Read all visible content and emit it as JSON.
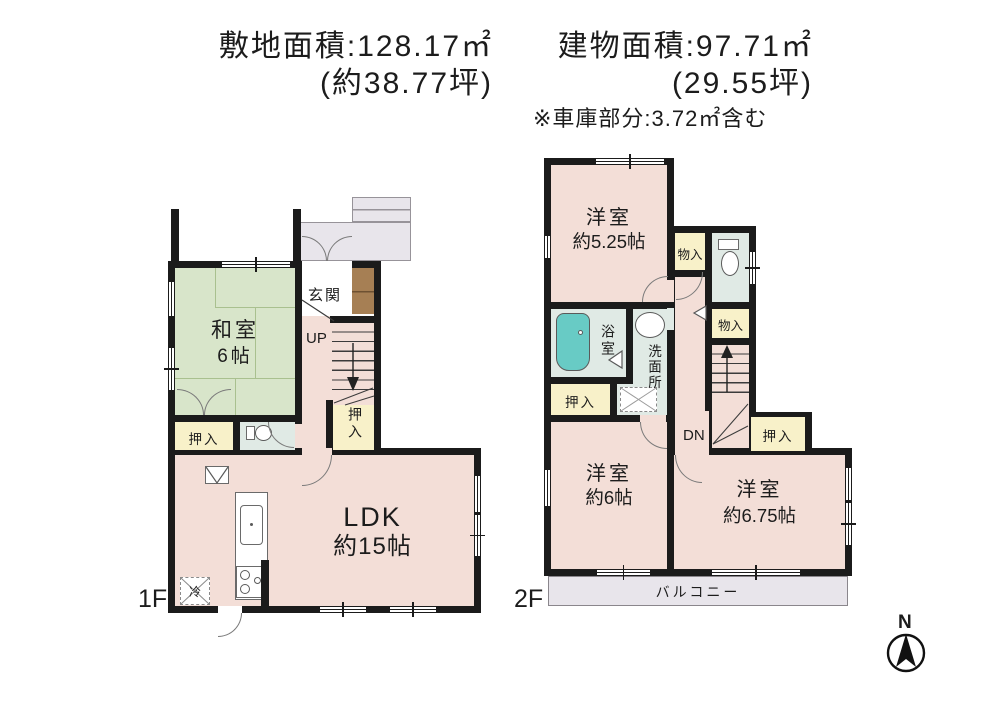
{
  "header": {
    "site_area": "敷地面積:128.17㎡",
    "site_area_tsubo": "(約38.77坪)",
    "building_area": "建物面積:97.71㎡",
    "building_area_tsubo": "(29.55坪)",
    "garage_note": "※車庫部分:3.72㎡含む"
  },
  "floor1": {
    "label": "1F",
    "washitsu_name": "和室",
    "washitsu_size": "6帖",
    "genkan": "玄関",
    "up": "UP",
    "oshiire_hall": "押入",
    "oshiire_left": "押入",
    "ldk_name": "LDK",
    "ldk_size": "約15帖",
    "fridge": "冷"
  },
  "floor2": {
    "label": "2F",
    "yoshitsu_525_name": "洋室",
    "yoshitsu_525_size": "約5.25帖",
    "monoire_top": "物入",
    "monoire_mid": "物入",
    "yokushitsu": "浴室",
    "senmenjo": "洗面所",
    "oshiire_left": "押入",
    "dn": "DN",
    "oshiire_right": "押入",
    "yoshitsu_6_name": "洋室",
    "yoshitsu_6_size": "約6帖",
    "yoshitsu_675_name": "洋室",
    "yoshitsu_675_size": "約6.75帖",
    "balcony": "バルコニー"
  },
  "compass": {
    "north": "N"
  },
  "colors": {
    "wall": "#1b1b1b",
    "room_pink": "#f3ded7",
    "tatami_green": "#d8e5ca",
    "closet_cream": "#f8f1c9",
    "wet_area": "#e0eae5",
    "bathtub_teal": "#68cbc5",
    "porch_gray": "#e8e5eb",
    "cabinet_brown": "#a67f54"
  }
}
